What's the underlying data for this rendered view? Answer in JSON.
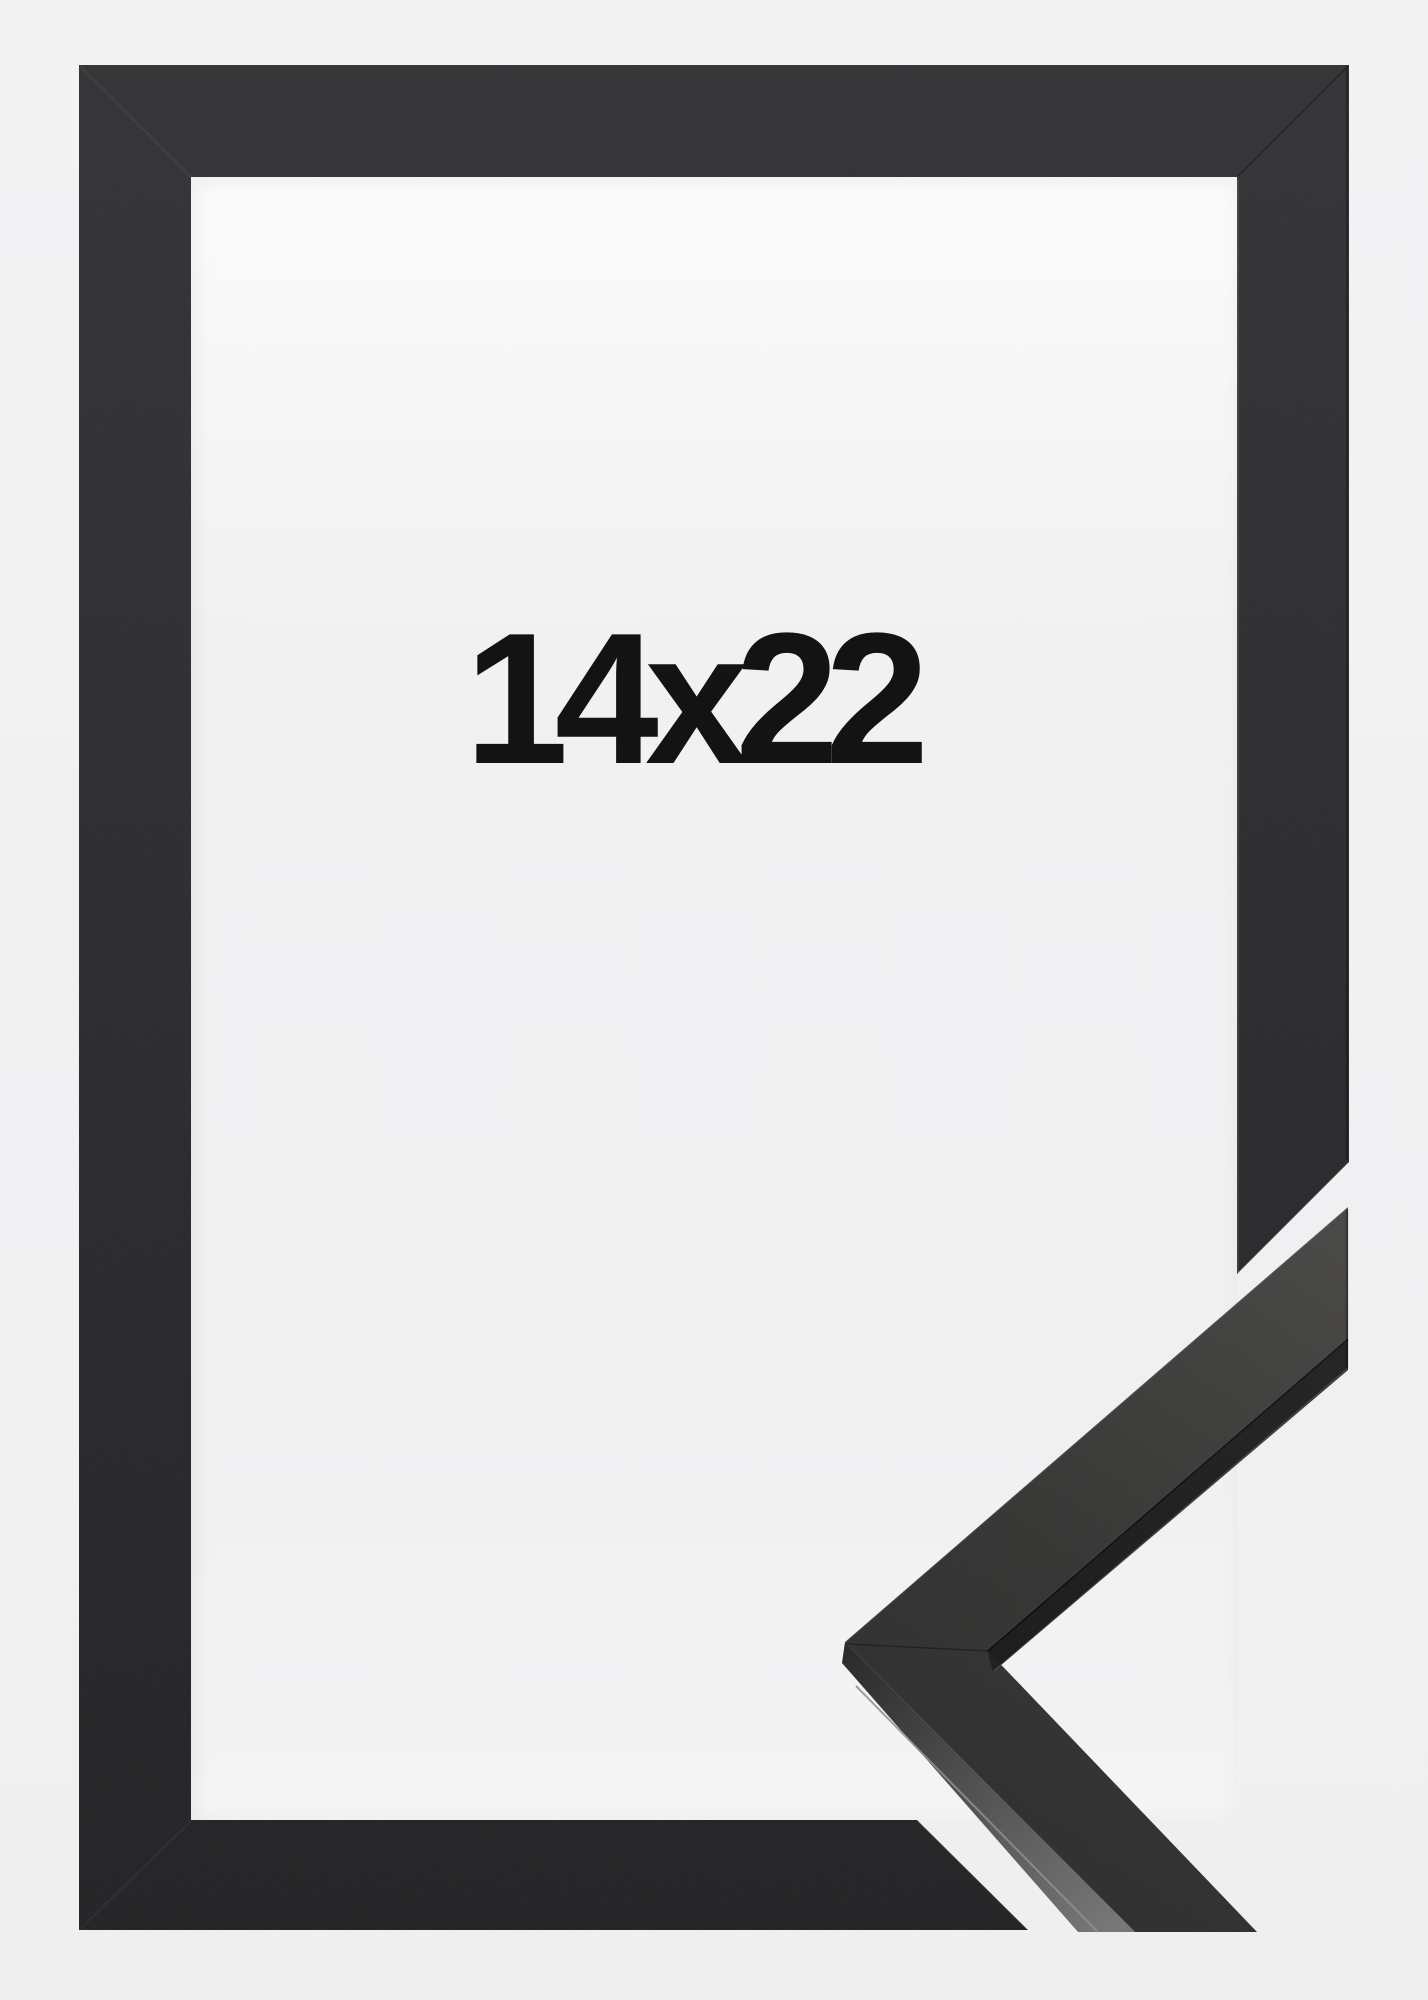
{
  "product_image": {
    "size_label": "14x22",
    "colors": {
      "background": "#f1f1f2",
      "opening_top": "#fbfbfc",
      "opening_bottom": "#f4f4f5",
      "frame_top": "#343437",
      "frame_bottom": "#232325",
      "sample_face_light": "#4a4947",
      "sample_face_dark": "#2b2b2b",
      "sample_side_light": "#777776",
      "sample_lip_dark": "#1e1e1e",
      "label_color": "#131313"
    }
  }
}
